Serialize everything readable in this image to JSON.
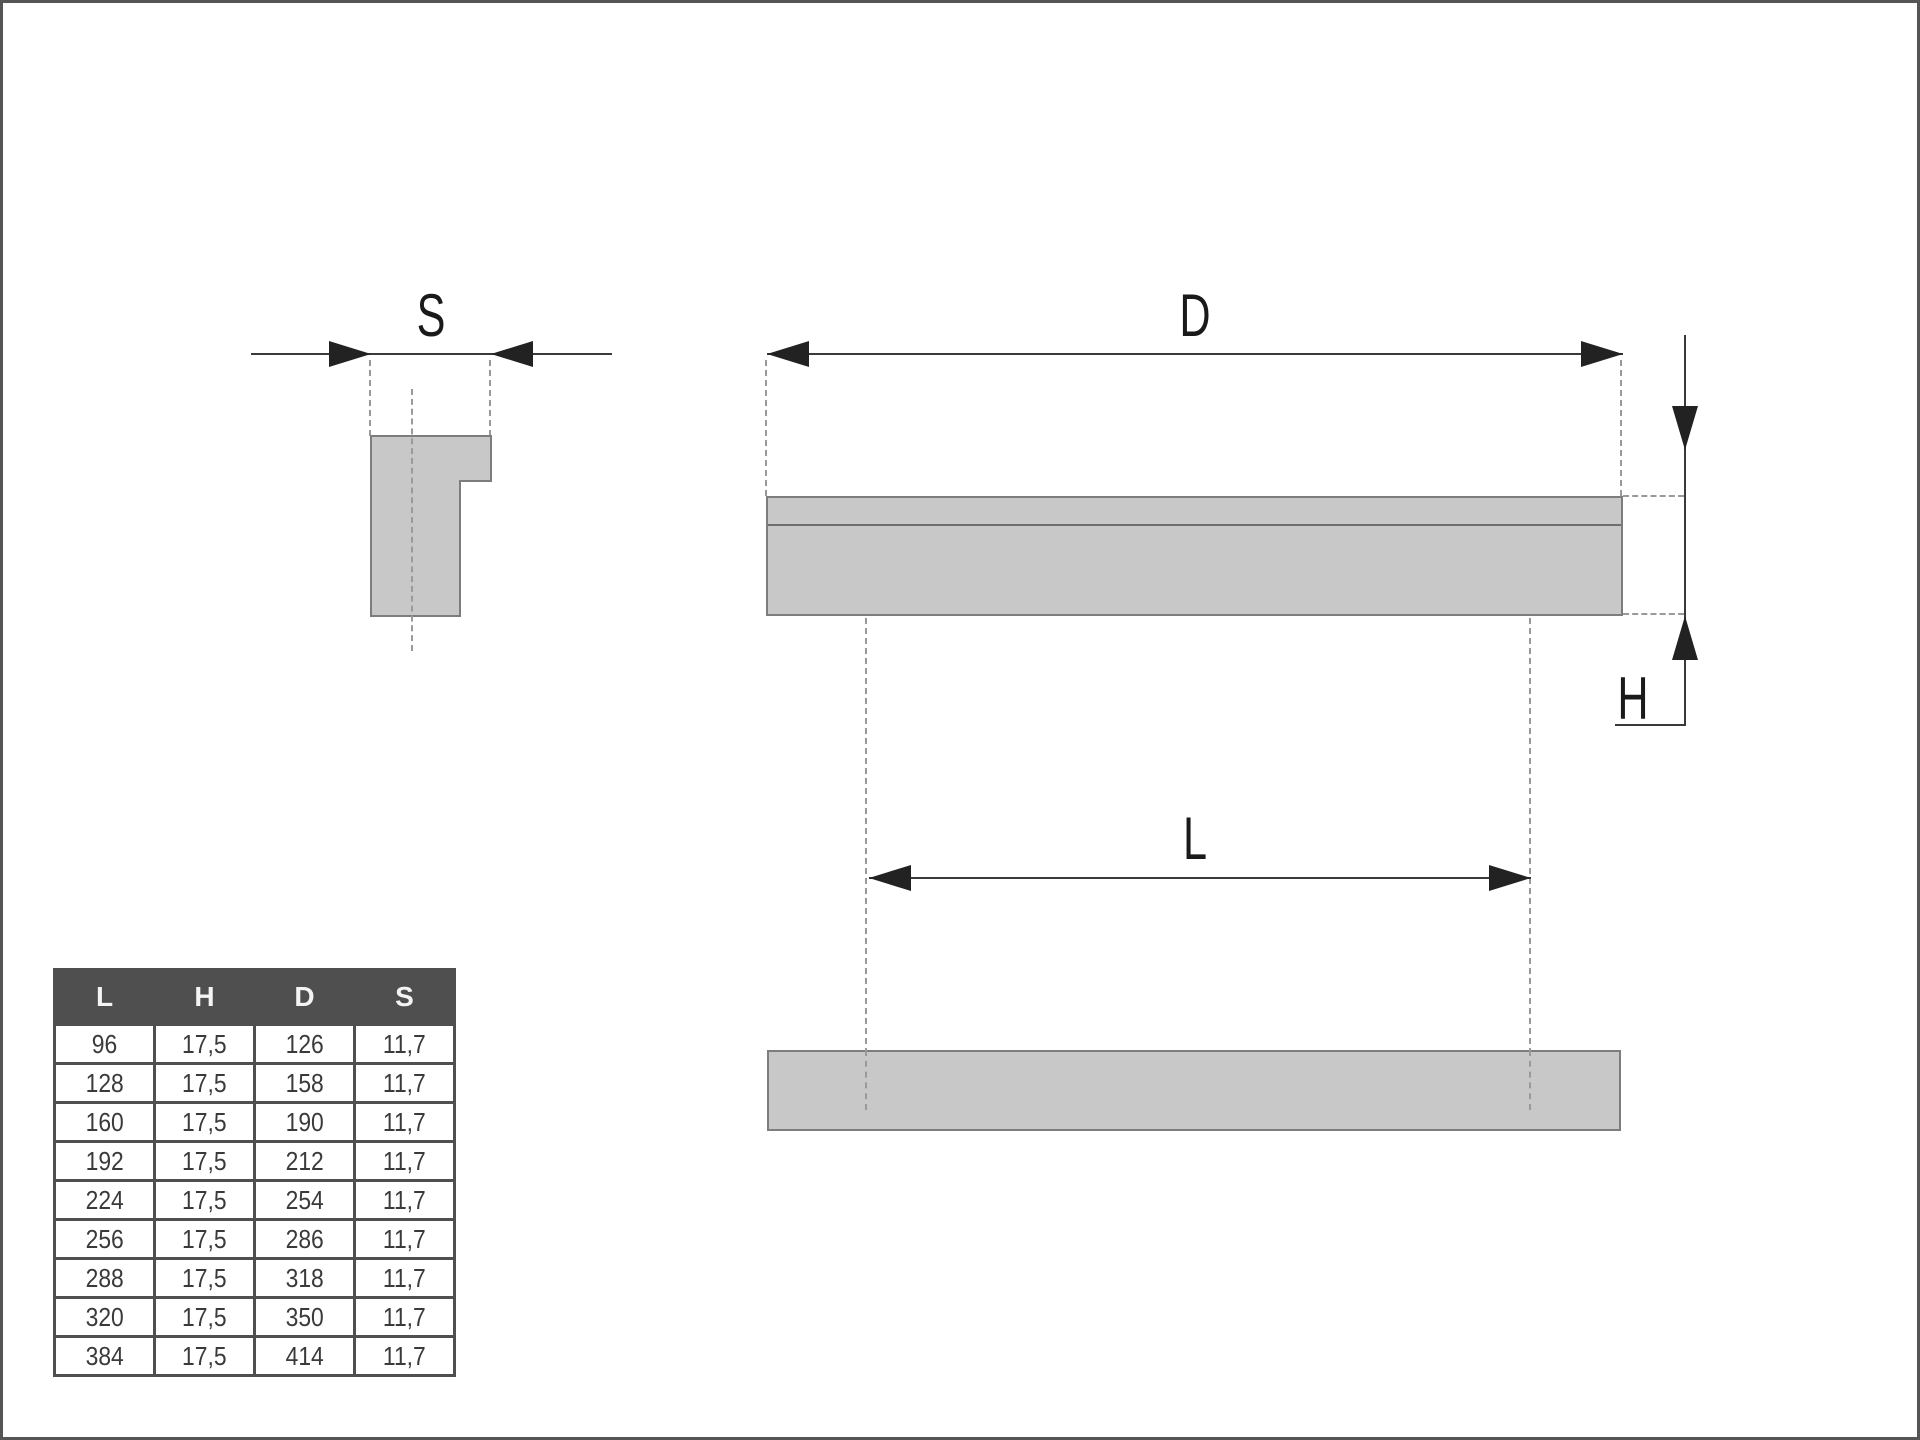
{
  "drawing": {
    "labels": {
      "s": "S",
      "d": "D",
      "l": "L",
      "h": "H"
    }
  },
  "table": {
    "columns": [
      "L",
      "H",
      "D",
      "S"
    ],
    "rows": [
      [
        "96",
        "17,5",
        "126",
        "11,7"
      ],
      [
        "128",
        "17,5",
        "158",
        "11,7"
      ],
      [
        "160",
        "17,5",
        "190",
        "11,7"
      ],
      [
        "192",
        "17,5",
        "212",
        "11,7"
      ],
      [
        "224",
        "17,5",
        "254",
        "11,7"
      ],
      [
        "256",
        "17,5",
        "286",
        "11,7"
      ],
      [
        "288",
        "17,5",
        "318",
        "11,7"
      ],
      [
        "320",
        "17,5",
        "350",
        "11,7"
      ],
      [
        "384",
        "17,5",
        "414",
        "11,7"
      ]
    ]
  },
  "colors": {
    "background": "#ffffff",
    "part_fill": "#c8c8c8",
    "part_stroke": "#7d7d7d",
    "dimension_line": "#3a3a3a",
    "dashed_line": "#9a9a9a",
    "table_header_bg": "#4f4f4f",
    "table_header_text": "#f4f4f4",
    "table_cell_text": "#3a3a3a",
    "frame": "#555555"
  }
}
